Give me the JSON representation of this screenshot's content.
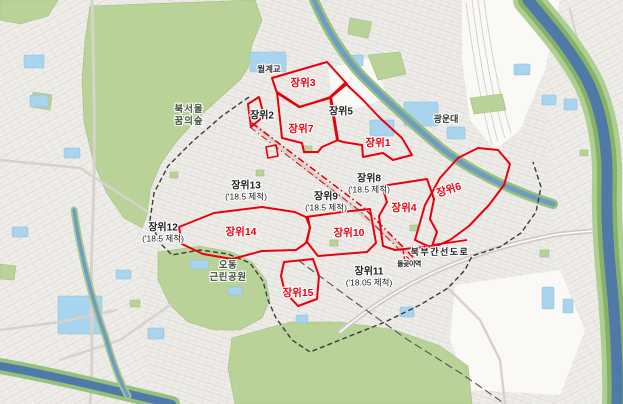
{
  "districts": [
    {
      "id": "jangwi1",
      "label": "장위1",
      "style": "red"
    },
    {
      "id": "jangwi2",
      "label": "장위2",
      "style": "black"
    },
    {
      "id": "jangwi3",
      "label": "장위3",
      "style": "red"
    },
    {
      "id": "jangwi4",
      "label": "장위4",
      "style": "red"
    },
    {
      "id": "jangwi5",
      "label": "장위5",
      "style": "black"
    },
    {
      "id": "jangwi6",
      "label": "장위6",
      "style": "red"
    },
    {
      "id": "jangwi7",
      "label": "장위7",
      "style": "red"
    },
    {
      "id": "jangwi8",
      "label": "장위8",
      "note": "('18.5 제척)",
      "style": "black"
    },
    {
      "id": "jangwi9",
      "label": "장위9",
      "note": "('18.5 제척)",
      "style": "black"
    },
    {
      "id": "jangwi10",
      "label": "장위10",
      "style": "red"
    },
    {
      "id": "jangwi11",
      "label": "장위11",
      "note": "('18.05 제척)",
      "style": "black"
    },
    {
      "id": "jangwi12",
      "label": "장위12",
      "note": "('18.5 제척)",
      "style": "black"
    },
    {
      "id": "jangwi13",
      "label": "장위13",
      "note": "('18.5 제척)",
      "style": "black"
    },
    {
      "id": "jangwi14",
      "label": "장위14",
      "style": "red"
    },
    {
      "id": "jangwi15",
      "label": "장위15",
      "style": "red"
    }
  ],
  "places": [
    {
      "id": "wolgye-bridge",
      "label": "월계교"
    },
    {
      "id": "bukseoul-dream-forest",
      "lines": [
        "북서울",
        "꿈의숲"
      ]
    },
    {
      "id": "kwangwoon-univ",
      "label": "광운대"
    },
    {
      "id": "odong-park",
      "lines": [
        "오동",
        "근린공원"
      ]
    },
    {
      "id": "bukbu-expressway",
      "label": "북부간선도로"
    },
    {
      "id": "dolgoji-station",
      "label": "돌곶이역"
    }
  ],
  "colors": {
    "zone_red": "#e8000f",
    "boundary_black": "#3a3a3a",
    "park_green": "#b9d298",
    "water_blue": "#4f79a6",
    "stream_blue": "#6f9cc2",
    "pond_blue": "#a9d4ee",
    "road_grey": "#d6d3cd",
    "background": "#f7f6f3"
  }
}
